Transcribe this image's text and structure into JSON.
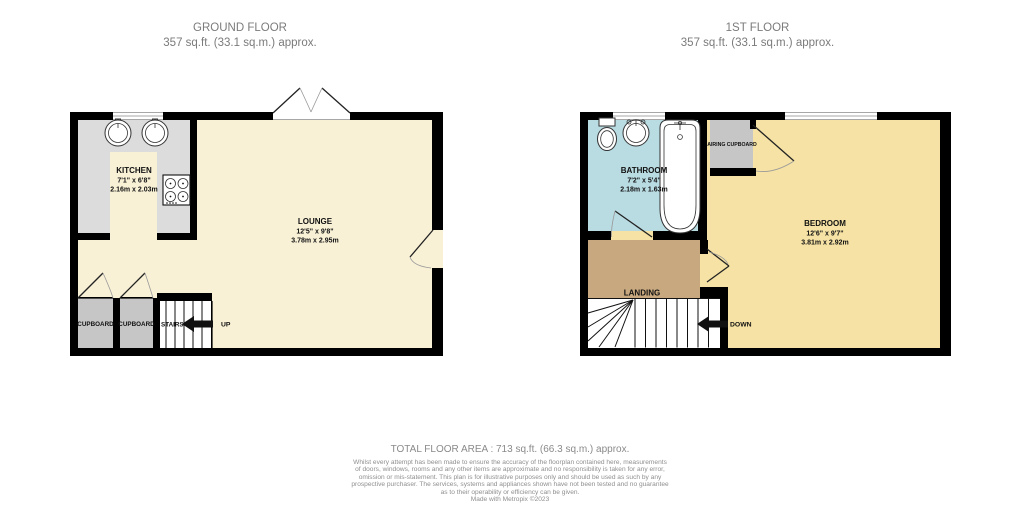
{
  "colors": {
    "wall": "#000000",
    "cream": "#F8F1D6",
    "gold": "#F5E2A4",
    "bathroom_blue": "#B9DBE2",
    "landing_tan": "#C8A87E",
    "counter_gray": "#DCDCDC",
    "cupboard_gray": "#C6C6C6",
    "title_gray": "#7B7B7B",
    "footer_gray": "#8A8A8A",
    "label_black": "#111111"
  },
  "ground_floor": {
    "title": "GROUND FLOOR",
    "area": "357 sq.ft. (33.1 sq.m.) approx.",
    "kitchen": {
      "name": "KITCHEN",
      "imperial": "7'1\" x 6'8\"",
      "metric": "2.16m x 2.03m"
    },
    "lounge": {
      "name": "LOUNGE",
      "imperial": "12'5\" x 9'8\"",
      "metric": "3.78m x 2.95m"
    },
    "cupboard1": "CUPBOARD",
    "cupboard2": "CUPBOARD",
    "stairs_label": "STAIRS",
    "up_label": "UP"
  },
  "first_floor": {
    "title": "1ST FLOOR",
    "area": "357 sq.ft. (33.1 sq.m.) approx.",
    "bathroom": {
      "name": "BATHROOM",
      "imperial": "7'2\" x 5'4\"",
      "metric": "2.18m x 1.63m"
    },
    "bedroom": {
      "name": "BEDROOM",
      "imperial": "12'6\" x 9'7\"",
      "metric": "3.81m x 2.92m"
    },
    "airing_cupboard": "AIRING CUPBOARD",
    "landing": "LANDING",
    "down_label": "DOWN"
  },
  "footer": {
    "total_area": "TOTAL FLOOR AREA : 713 sq.ft. (66.3 sq.m.) approx.",
    "disclaimer": "Whilst every attempt has been made to ensure the accuracy of the floorplan contained here, measurements\nof doors, windows, rooms and any other items are approximate and no responsibility is taken for any error,\nomission or mis-statement. This plan is for illustrative purposes only and should be used as such by any\nprospective purchaser. The services, systems and appliances shown have not been tested and no guarantee\nas to their operability or efficiency can be given.",
    "credit": "Made with Metropix ©2023"
  }
}
